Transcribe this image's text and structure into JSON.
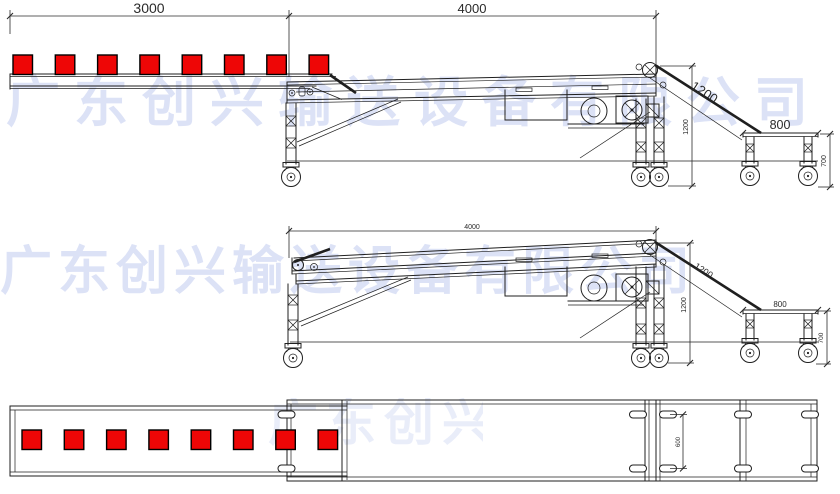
{
  "watermark": {
    "text": "广东创兴输送设备有限公司",
    "color": "#b3bfec"
  },
  "colors": {
    "line": "#1f1f1f",
    "dim": "#2a2a2a",
    "box_fill": "#ee0606",
    "box_stroke": "#000000",
    "background": "#ffffff"
  },
  "views": {
    "side_extended": {
      "product_box_count": 8,
      "dims": {
        "infeed_length": "3000",
        "main_length": "4000",
        "incline_length": "1200",
        "frame_height": "1200",
        "discharge_length": "800",
        "discharge_height": "700"
      }
    },
    "side_retracted": {
      "dims": {
        "main_length": "4000",
        "incline_length": "1200",
        "frame_height": "1200",
        "discharge_length": "800",
        "discharge_height": "700"
      }
    },
    "plan": {
      "product_box_count": 8,
      "dims": {
        "slot_spacing": "600"
      }
    }
  }
}
